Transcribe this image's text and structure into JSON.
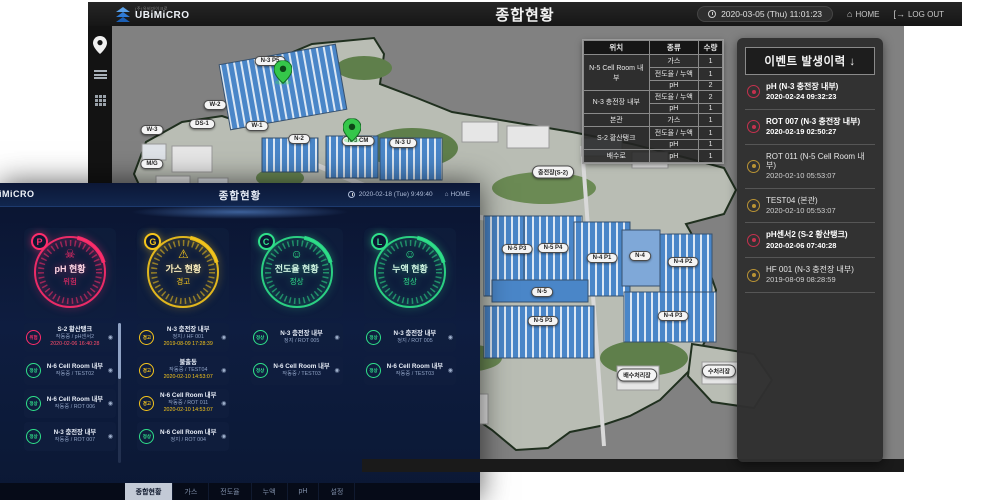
{
  "colors": {
    "danger": "#ff2d6b",
    "warning": "#f5c51c",
    "normal": "#2fe08a",
    "accent_blue": "#2e7bd6"
  },
  "background_window": {
    "header": {
      "logo_text": "UBiMiCRO",
      "logo_tagline": "(주)유비마이크로",
      "title": "종합현황",
      "clock": "2020-03-05 (Thu) 11:01:23",
      "home_label": "HOME",
      "logout_label": "LOG OUT"
    },
    "sensor_table": {
      "headers": [
        "위치",
        "종류",
        "수량"
      ],
      "groups": [
        {
          "location": "N-5 Cell Room 내부",
          "rows": [
            [
              "가스",
              "1"
            ],
            [
              "전도율 / 누액",
              "1"
            ],
            [
              "pH",
              "2"
            ]
          ]
        },
        {
          "location": "N-3 충전장 내부",
          "rows": [
            [
              "전도율 / 누액",
              "2"
            ],
            [
              "pH",
              "1"
            ]
          ]
        },
        {
          "location": "본관",
          "rows": [
            [
              "가스",
              "1"
            ]
          ]
        },
        {
          "location": "S-2 황산탱크",
          "rows": [
            [
              "전도율 / 누액",
              "1"
            ],
            [
              "pH",
              "1"
            ]
          ]
        },
        {
          "location": "배수로",
          "rows": [
            [
              "pH",
              "1"
            ]
          ]
        }
      ]
    },
    "event_panel": {
      "title": "이벤트 발생이력 ↓",
      "entries": [
        {
          "name": "pH (N-3 충전장 내부)",
          "time": "2020-02-24 09:32:23",
          "severity": "danger"
        },
        {
          "name": "ROT 007 (N-3 충전장 내부)",
          "time": "2020-02-19 02:50:27",
          "severity": "danger"
        },
        {
          "name": "ROT 011 (N-5 Cell Room 내부)",
          "time": "2020-02-10 05:53:07",
          "severity": "warning"
        },
        {
          "name": "TEST04 (본관)",
          "time": "2020-02-10 05:53:07",
          "severity": "warning"
        },
        {
          "name": "pH센서2 (S-2 황산탱크)",
          "time": "2020-02-06 07:40:28",
          "severity": "danger"
        },
        {
          "name": "HF 001 (N-3 충전장 내부)",
          "time": "2019-08-09 08:28:59",
          "severity": "warning"
        }
      ]
    },
    "map": {
      "labels": [
        {
          "text": "N-3 P5",
          "x": 158,
          "y": 35
        },
        {
          "text": "W-2",
          "x": 103,
          "y": 79
        },
        {
          "text": "DS-1",
          "x": 90,
          "y": 98
        },
        {
          "text": "W-3",
          "x": 40,
          "y": 104
        },
        {
          "text": "M/G",
          "x": 40,
          "y": 138
        },
        {
          "text": "W-1",
          "x": 145,
          "y": 100
        },
        {
          "text": "N-2",
          "x": 187,
          "y": 113
        },
        {
          "text": "N-3 CM",
          "x": 246,
          "y": 115
        },
        {
          "text": "N-3 U",
          "x": 291,
          "y": 117
        },
        {
          "text": "충전장(S-2)",
          "x": 441,
          "y": 146
        },
        {
          "text": "N-5 P3",
          "x": 405,
          "y": 223
        },
        {
          "text": "N-5 P4",
          "x": 441,
          "y": 222
        },
        {
          "text": "N-4 P1",
          "x": 490,
          "y": 232
        },
        {
          "text": "N-4",
          "x": 528,
          "y": 230
        },
        {
          "text": "N-4 P2",
          "x": 571,
          "y": 236
        },
        {
          "text": "N-5",
          "x": 430,
          "y": 266
        },
        {
          "text": "N-5 P3",
          "x": 431,
          "y": 295
        },
        {
          "text": "N-4 P3",
          "x": 561,
          "y": 290
        },
        {
          "text": "배수처리장",
          "x": 525,
          "y": 349
        },
        {
          "text": "수처리장",
          "x": 607,
          "y": 345
        }
      ],
      "pins": [
        {
          "x": 171,
          "y": 61
        },
        {
          "x": 240,
          "y": 119
        }
      ]
    }
  },
  "foreground_window": {
    "header": {
      "logo_text": "UBiMiCRO",
      "title": "종합현황",
      "clock": "2020-02-18 (Tue) 9:49:40",
      "home_label": "HOME"
    },
    "gauges": [
      {
        "letter": "P",
        "label": "pH 현황",
        "status": "위험",
        "level": "danger",
        "icon": "skull"
      },
      {
        "letter": "G",
        "label": "가스 현황",
        "status": "경고",
        "level": "warning",
        "icon": "warning"
      },
      {
        "letter": "C",
        "label": "전도율 현황",
        "status": "정상",
        "level": "normal",
        "icon": "smile"
      },
      {
        "letter": "L",
        "label": "누액 현황",
        "status": "정상",
        "level": "normal",
        "icon": "smile"
      }
    ],
    "columns": [
      {
        "items": [
          {
            "badge": "위험",
            "level": "danger",
            "title": "S-2 황산탱크",
            "sub": "작동중 / pH센서2",
            "date": "2020-02-06 16:40:28"
          },
          {
            "badge": "정상",
            "level": "normal",
            "title": "N-6 Cell Room 내부",
            "sub": "작동중 / TEST02"
          },
          {
            "badge": "정상",
            "level": "normal",
            "title": "N-6 Cell Room 내부",
            "sub": "작동중 / ROT 006"
          },
          {
            "badge": "정상",
            "level": "normal",
            "title": "N-3 충전장 내부",
            "sub": "작동중 / ROT 007"
          }
        ]
      },
      {
        "items": [
          {
            "badge": "경고",
            "level": "warning",
            "title": "N-3 충전장 내부",
            "sub": "정지 / HF 001",
            "date": "2019-08-09 17:28:39"
          },
          {
            "badge": "경고",
            "level": "warning",
            "title": "불출동",
            "sub": "작동중 / TEST04",
            "date": "2020-02-10 14:53:07"
          },
          {
            "badge": "경고",
            "level": "warning",
            "title": "N-6 Cell Room 내부",
            "sub": "작동중 / ROT 011",
            "date": "2020-02-10 14:53:07"
          },
          {
            "badge": "정상",
            "level": "normal",
            "title": "N-6 Cell Room 내부",
            "sub": "정지 / ROT 004"
          }
        ]
      },
      {
        "items": [
          {
            "badge": "정상",
            "level": "normal",
            "title": "N-3 충전장 내부",
            "sub": "정지 / ROT 005"
          },
          {
            "badge": "정상",
            "level": "normal",
            "title": "N-6 Cell Room 내부",
            "sub": "작동중 / TEST03"
          }
        ]
      },
      {
        "items": [
          {
            "badge": "정상",
            "level": "normal",
            "title": "N-3 충전장 내부",
            "sub": "정지 / ROT 005"
          },
          {
            "badge": "정상",
            "level": "normal",
            "title": "N-6 Cell Room 내부",
            "sub": "작동중 / TEST03"
          }
        ]
      }
    ],
    "tabs": [
      {
        "label": "종합현황",
        "active": true
      },
      {
        "label": "가스",
        "active": false
      },
      {
        "label": "전도율",
        "active": false
      },
      {
        "label": "누액",
        "active": false
      },
      {
        "label": "pH",
        "active": false
      },
      {
        "label": "설정",
        "active": false
      }
    ]
  }
}
